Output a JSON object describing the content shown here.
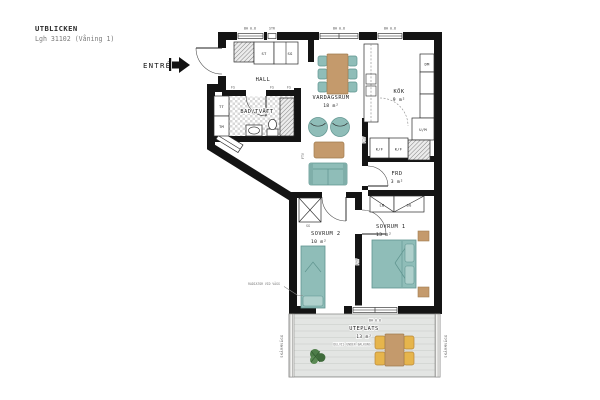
{
  "header": {
    "project": "UTBLICKEN",
    "apartment": "Lgh 31102 (Våning 1)"
  },
  "entry": {
    "label": "ENTRÉ"
  },
  "rooms": {
    "hall": {
      "name": "HALL"
    },
    "bathroom": {
      "name": "BAD/TVÄTT"
    },
    "living": {
      "name": "VARDAGSRUM",
      "area": "18 m²"
    },
    "kitchen": {
      "name": "KÖK",
      "area": "9 m²"
    },
    "storage": {
      "name": "FRD",
      "area": "3 m²"
    },
    "bedroom2": {
      "name": "SOVRUM 2",
      "area": "10 m²"
    },
    "bedroom1": {
      "name": "SOVRUM 1",
      "area": "13 m²"
    },
    "patio": {
      "name": "UTEPLATS",
      "area": "13 m²"
    }
  },
  "fixtures": {
    "tt": "TT",
    "tm": "TM",
    "st": "ST",
    "sg": "SG",
    "dm": "DM",
    "um": "U/M",
    "kf": "K/F",
    "lb": "LB",
    "fs": "FS",
    "ftv": "FTV"
  },
  "annotations": {
    "window_height": "BH 0.8",
    "stairwell": "STR",
    "screen_wall": "SKÄRMVÄGG",
    "radiator_note": "RADIATOR VID VÄGG",
    "patio_note": "DELVIS UNDER BALKONG"
  },
  "colors": {
    "wall": "#141414",
    "upholstery": "#8FBDB8",
    "upholstery_light": "#AFD0CC",
    "wood": "#C49A6C",
    "patio_chair": "#E6B54C",
    "deck": "#E3E5E3",
    "plant": "#4E7D49"
  }
}
